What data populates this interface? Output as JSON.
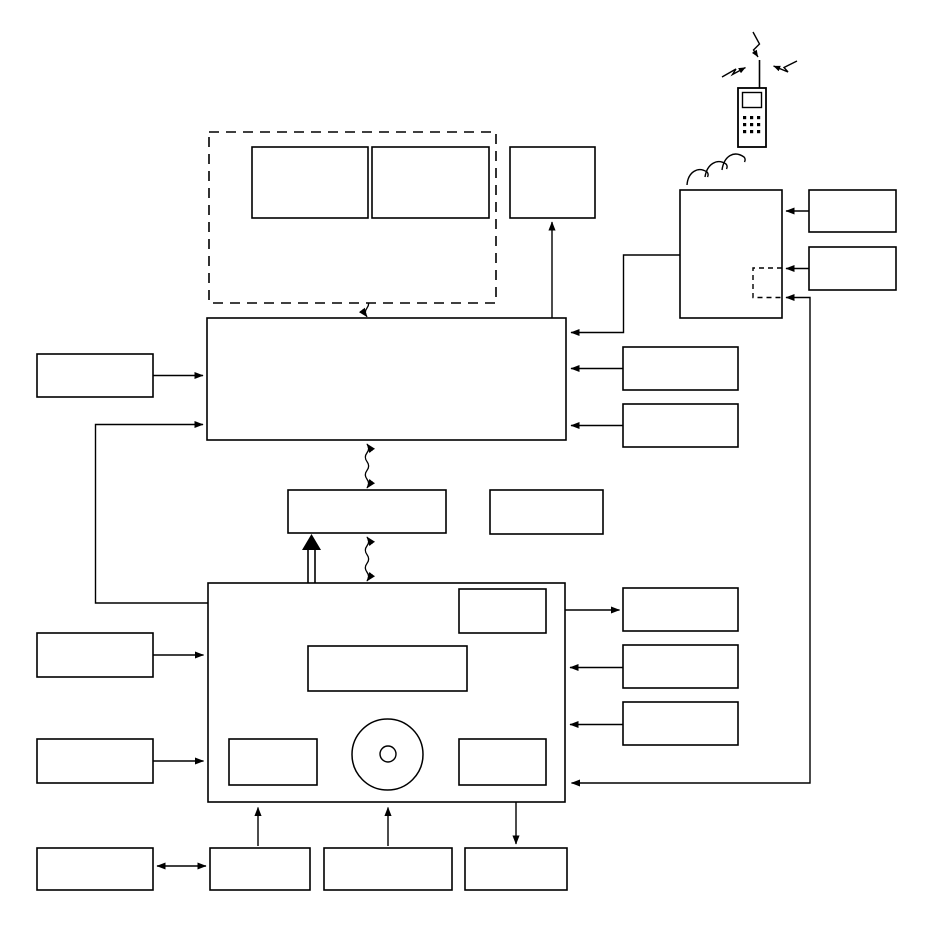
{
  "diagram": {
    "type": "block-diagram",
    "description": "Patent-style line drawing: unlabeled rectangular blocks connected by arrows, wavy cable links, a dashed signal path with break symbols, an optical disc symbol inside the lower main block, and a mobile phone with RF lightning arrows and radio waves communicating with an RF module at top right.",
    "colors": {
      "background": "#ffffff",
      "line": "#000000"
    },
    "nodes": [
      {
        "id": "dashed-enclosure",
        "label": ""
      },
      {
        "id": "enclosure-box-left",
        "label": ""
      },
      {
        "id": "enclosure-box-right",
        "label": ""
      },
      {
        "id": "top-right-output-box",
        "label": ""
      },
      {
        "id": "upper-main-block",
        "label": ""
      },
      {
        "id": "interface-block",
        "label": ""
      },
      {
        "id": "interface-side-box",
        "label": ""
      },
      {
        "id": "lower-main-block",
        "label": ""
      },
      {
        "id": "lower-inner-top-right-box",
        "label": ""
      },
      {
        "id": "lower-inner-center-box",
        "label": ""
      },
      {
        "id": "lower-inner-bottom-left-box",
        "label": ""
      },
      {
        "id": "optical-disc",
        "label": ""
      },
      {
        "id": "lower-inner-bottom-right-box",
        "label": ""
      },
      {
        "id": "left-box-1",
        "label": ""
      },
      {
        "id": "left-box-2",
        "label": ""
      },
      {
        "id": "left-box-3",
        "label": ""
      },
      {
        "id": "left-box-4",
        "label": ""
      },
      {
        "id": "bottom-box-1",
        "label": ""
      },
      {
        "id": "bottom-box-2",
        "label": ""
      },
      {
        "id": "bottom-box-3",
        "label": ""
      },
      {
        "id": "right-box-1",
        "label": ""
      },
      {
        "id": "right-box-2",
        "label": ""
      },
      {
        "id": "right-box-3",
        "label": ""
      },
      {
        "id": "right-box-4",
        "label": ""
      },
      {
        "id": "right-box-5",
        "label": ""
      },
      {
        "id": "rf-module-box",
        "label": ""
      },
      {
        "id": "rf-dashed-sub-box",
        "label": ""
      },
      {
        "id": "rf-side-box-1",
        "label": ""
      },
      {
        "id": "rf-side-box-2",
        "label": ""
      },
      {
        "id": "mobile-phone",
        "label": ""
      }
    ],
    "edges": [
      {
        "from": "left-box-1",
        "to": "upper-main-block",
        "style": "arrow"
      },
      {
        "from": "lower-main-block",
        "to": "upper-main-block",
        "style": "arrow"
      },
      {
        "from": "right-box-1",
        "to": "upper-main-block",
        "style": "arrow"
      },
      {
        "from": "right-box-2",
        "to": "upper-main-block",
        "style": "arrow"
      },
      {
        "from": "rf-module-box",
        "to": "upper-main-block",
        "style": "arrow"
      },
      {
        "from": "upper-main-block",
        "to": "top-right-output-box",
        "style": "arrow"
      },
      {
        "from": "rf-side-box-1",
        "to": "rf-module-box",
        "style": "arrow"
      },
      {
        "from": "rf-side-box-2",
        "to": "rf-module-box",
        "style": "arrow"
      },
      {
        "from": "rf-dashed-sub-box",
        "to": "lower-main-block",
        "style": "double-arrow"
      },
      {
        "from": "upper-main-block",
        "to": "enclosure-box-left",
        "style": "wavy-arrow"
      },
      {
        "from": "upper-main-block",
        "to": "enclosure-box-right",
        "style": "wavy-arrow"
      },
      {
        "from": "upper-main-block",
        "to": "interface-block",
        "style": "wavy-double-arrow"
      },
      {
        "from": "interface-block",
        "to": "lower-main-block",
        "style": "wavy-double-arrow"
      },
      {
        "from": "interface-side-box",
        "to": "interface-block",
        "style": "arrow"
      },
      {
        "from": "lower-main-block",
        "to": "interface-block",
        "style": "thick-arrow"
      },
      {
        "from": "left-box-2",
        "to": "lower-main-block",
        "style": "arrow"
      },
      {
        "from": "left-box-3",
        "to": "lower-main-block",
        "style": "arrow"
      },
      {
        "from": "left-box-4",
        "to": "bottom-box-1",
        "style": "double-arrow"
      },
      {
        "from": "bottom-box-1",
        "to": "lower-main-block",
        "style": "arrow"
      },
      {
        "from": "bottom-box-2",
        "to": "lower-main-block",
        "style": "arrow"
      },
      {
        "from": "bottom-box-3",
        "to": "lower-inner-bottom-right-box",
        "style": "double-arrow"
      },
      {
        "from": "right-box-3",
        "to": "lower-inner-top-right-box",
        "style": "double-arrow"
      },
      {
        "from": "right-box-4",
        "to": "lower-main-block",
        "style": "arrow"
      },
      {
        "from": "right-box-5",
        "to": "lower-main-block",
        "style": "arrow"
      },
      {
        "from": "upper-main-block",
        "to": "lower-main-block",
        "style": "dashed-line-with-break-symbols"
      }
    ]
  },
  "icons": [
    {
      "name": "mobile-phone-icon"
    },
    {
      "name": "antenna-icon"
    },
    {
      "name": "rf-lightning-arrows-icon"
    },
    {
      "name": "radio-waves-icon"
    },
    {
      "name": "optical-disc-icon"
    },
    {
      "name": "cable-break-symbol"
    }
  ]
}
